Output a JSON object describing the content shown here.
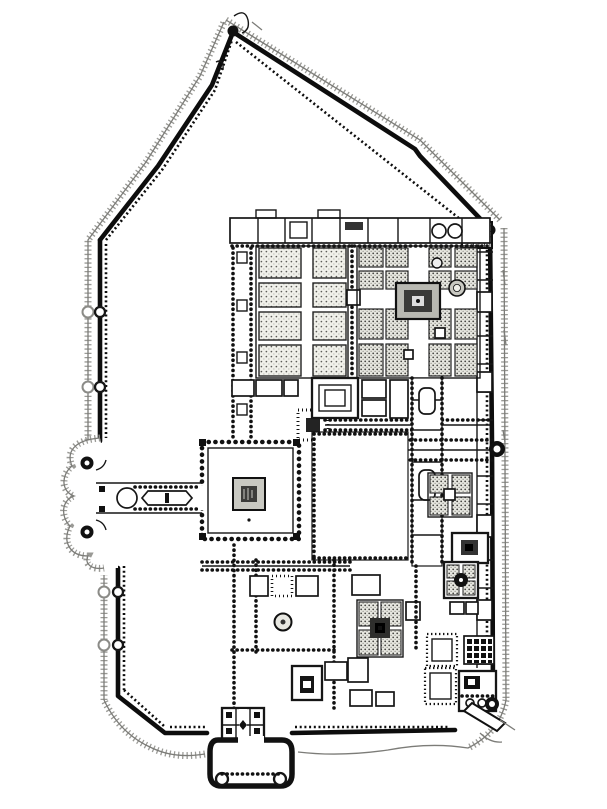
{
  "figure": {
    "kind": "architectural-plan",
    "subject": "walled fort-palace complex ground plan (engraved survey style)",
    "canvas": {
      "width": 607,
      "height": 809
    },
    "colors": {
      "paper": "#ffffff",
      "ink": "#0d0d0d",
      "hatching": "#9a9a96",
      "pavilion_shade": "#b9b9b2",
      "plot_stipple": "#e9e9e3"
    },
    "features": [
      {
        "name": "outer-rampart",
        "role": "crenellated enclosure wall with pointed north apex"
      },
      {
        "name": "glacis-hatching",
        "role": "hatched scarp line outside the rampart"
      },
      {
        "name": "west-gate-outwork",
        "role": "semicircular bastioned barbican on west wall"
      },
      {
        "name": "entrance-colonnade",
        "role": "columned passage from west gate to central court"
      },
      {
        "name": "central-court-pavilion",
        "role": "square court with central pavilion"
      },
      {
        "name": "northwest-garden",
        "role": "eight stippled planting plots"
      },
      {
        "name": "northeast-charbagh",
        "role": "four-quartered garden with central pavilion"
      },
      {
        "name": "charbagh-pavilion",
        "role": "dark central pavilion of charbagh"
      },
      {
        "name": "north-range",
        "role": "row of chambers along north wall"
      },
      {
        "name": "east-wall-chambers",
        "role": "double east wall with cells and bastion knob"
      },
      {
        "name": "great-court",
        "role": "large open colonnaded courtyard"
      },
      {
        "name": "small-charbagh",
        "role": "four-plot garden with central basin"
      },
      {
        "name": "quatrefoil-bath",
        "role": "bath block with round central basin"
      },
      {
        "name": "hypostyle-hall",
        "role": "grid of piers in SE corner"
      },
      {
        "name": "fountain-basin",
        "role": "round fountain in south court"
      },
      {
        "name": "garden-pavilion-south",
        "role": "stippled garden with dark pavilion"
      },
      {
        "name": "south-gate",
        "role": "gatehouse with rectangular barbican outwork"
      },
      {
        "name": "southeast-gate",
        "role": "corner gate with round bastion and ramp"
      }
    ]
  }
}
